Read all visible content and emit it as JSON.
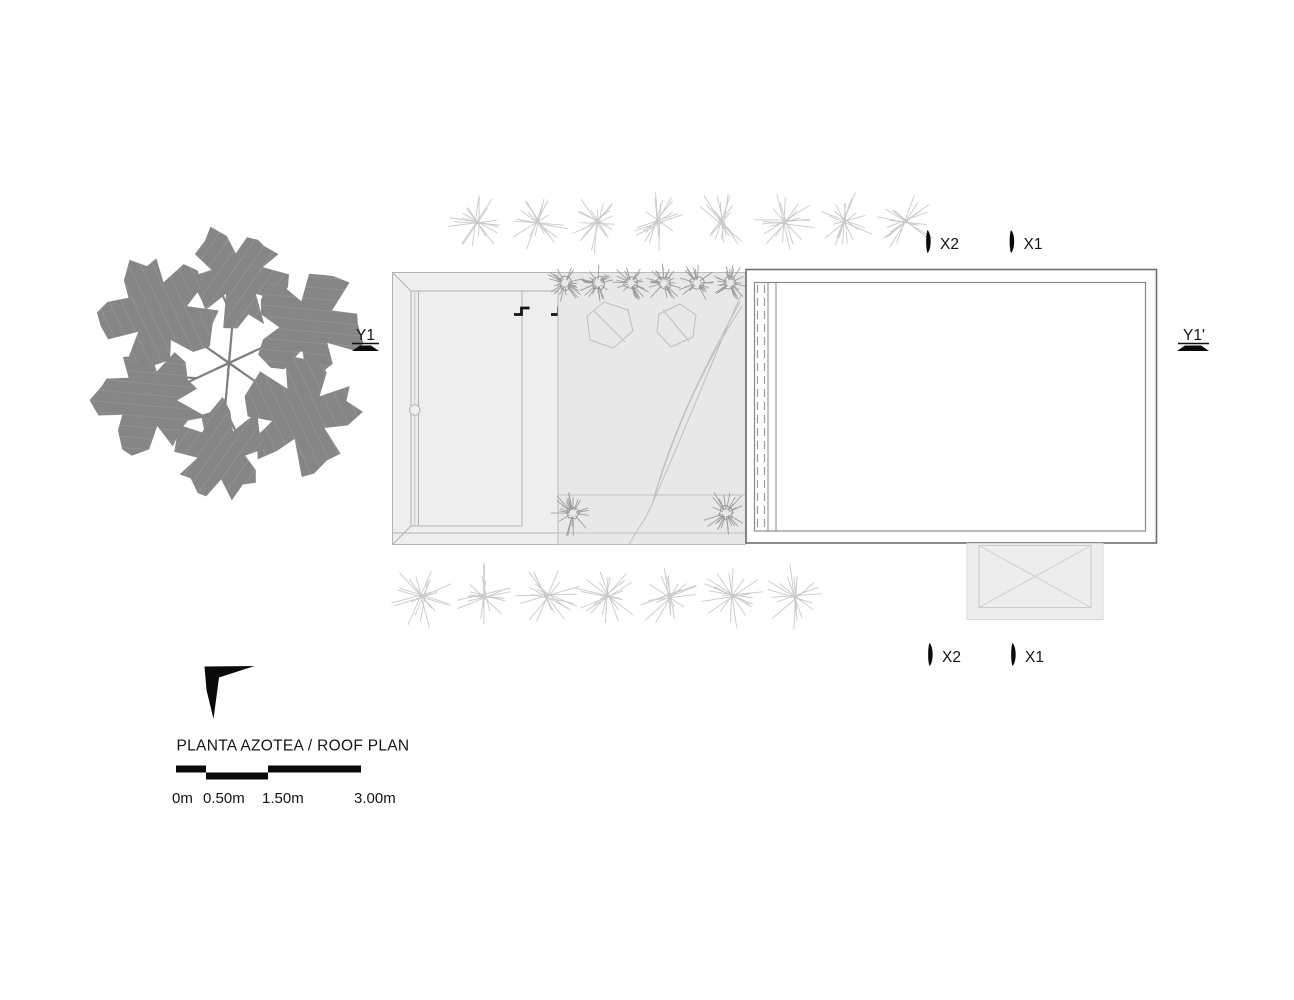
{
  "drawing": {
    "title": "PLANTA AZOTEA / ROOF PLAN",
    "type_note": "architectural roof plan, black/gray linework on white"
  },
  "section_markers": {
    "y1": {
      "label": "Y1"
    },
    "y1_prime": {
      "label": "Y1'"
    },
    "x2_top": {
      "label": "X2"
    },
    "x1_top": {
      "label": "X1"
    },
    "x2_bottom": {
      "label": "X2"
    },
    "x1_bottom": {
      "label": "X1"
    }
  },
  "scale_bar": {
    "labels": [
      "0m",
      "0.50m",
      "1.50m",
      "3.00m"
    ]
  },
  "icons": {
    "north_arrow": "north-arrow",
    "tree": "tree-canopy-plan",
    "grass": "grass-starburst",
    "shrub": "shrub-starburst",
    "step": "roof-step-symbol",
    "section_cut": "section-cut-marker"
  },
  "colors": {
    "foliage": "#868686",
    "branch": "#7f7f7f",
    "deck_fill": "#eeeeee",
    "courtyard_fill": "#e8e8e8",
    "annex_fill": "#ededed",
    "roof_outline": "#6e6e6e",
    "roof_inner": "#8a8a8a",
    "detail_line": "#bdbdbd",
    "grass_line": "#c9c9c9",
    "marker_black": "#0a0a0a"
  },
  "vegetation": {
    "grass_top_count": 8,
    "grass_bottom_count": 7,
    "shrub_row_count": 6,
    "band_shrub_count": 2,
    "tree_cluster_count": 6
  }
}
